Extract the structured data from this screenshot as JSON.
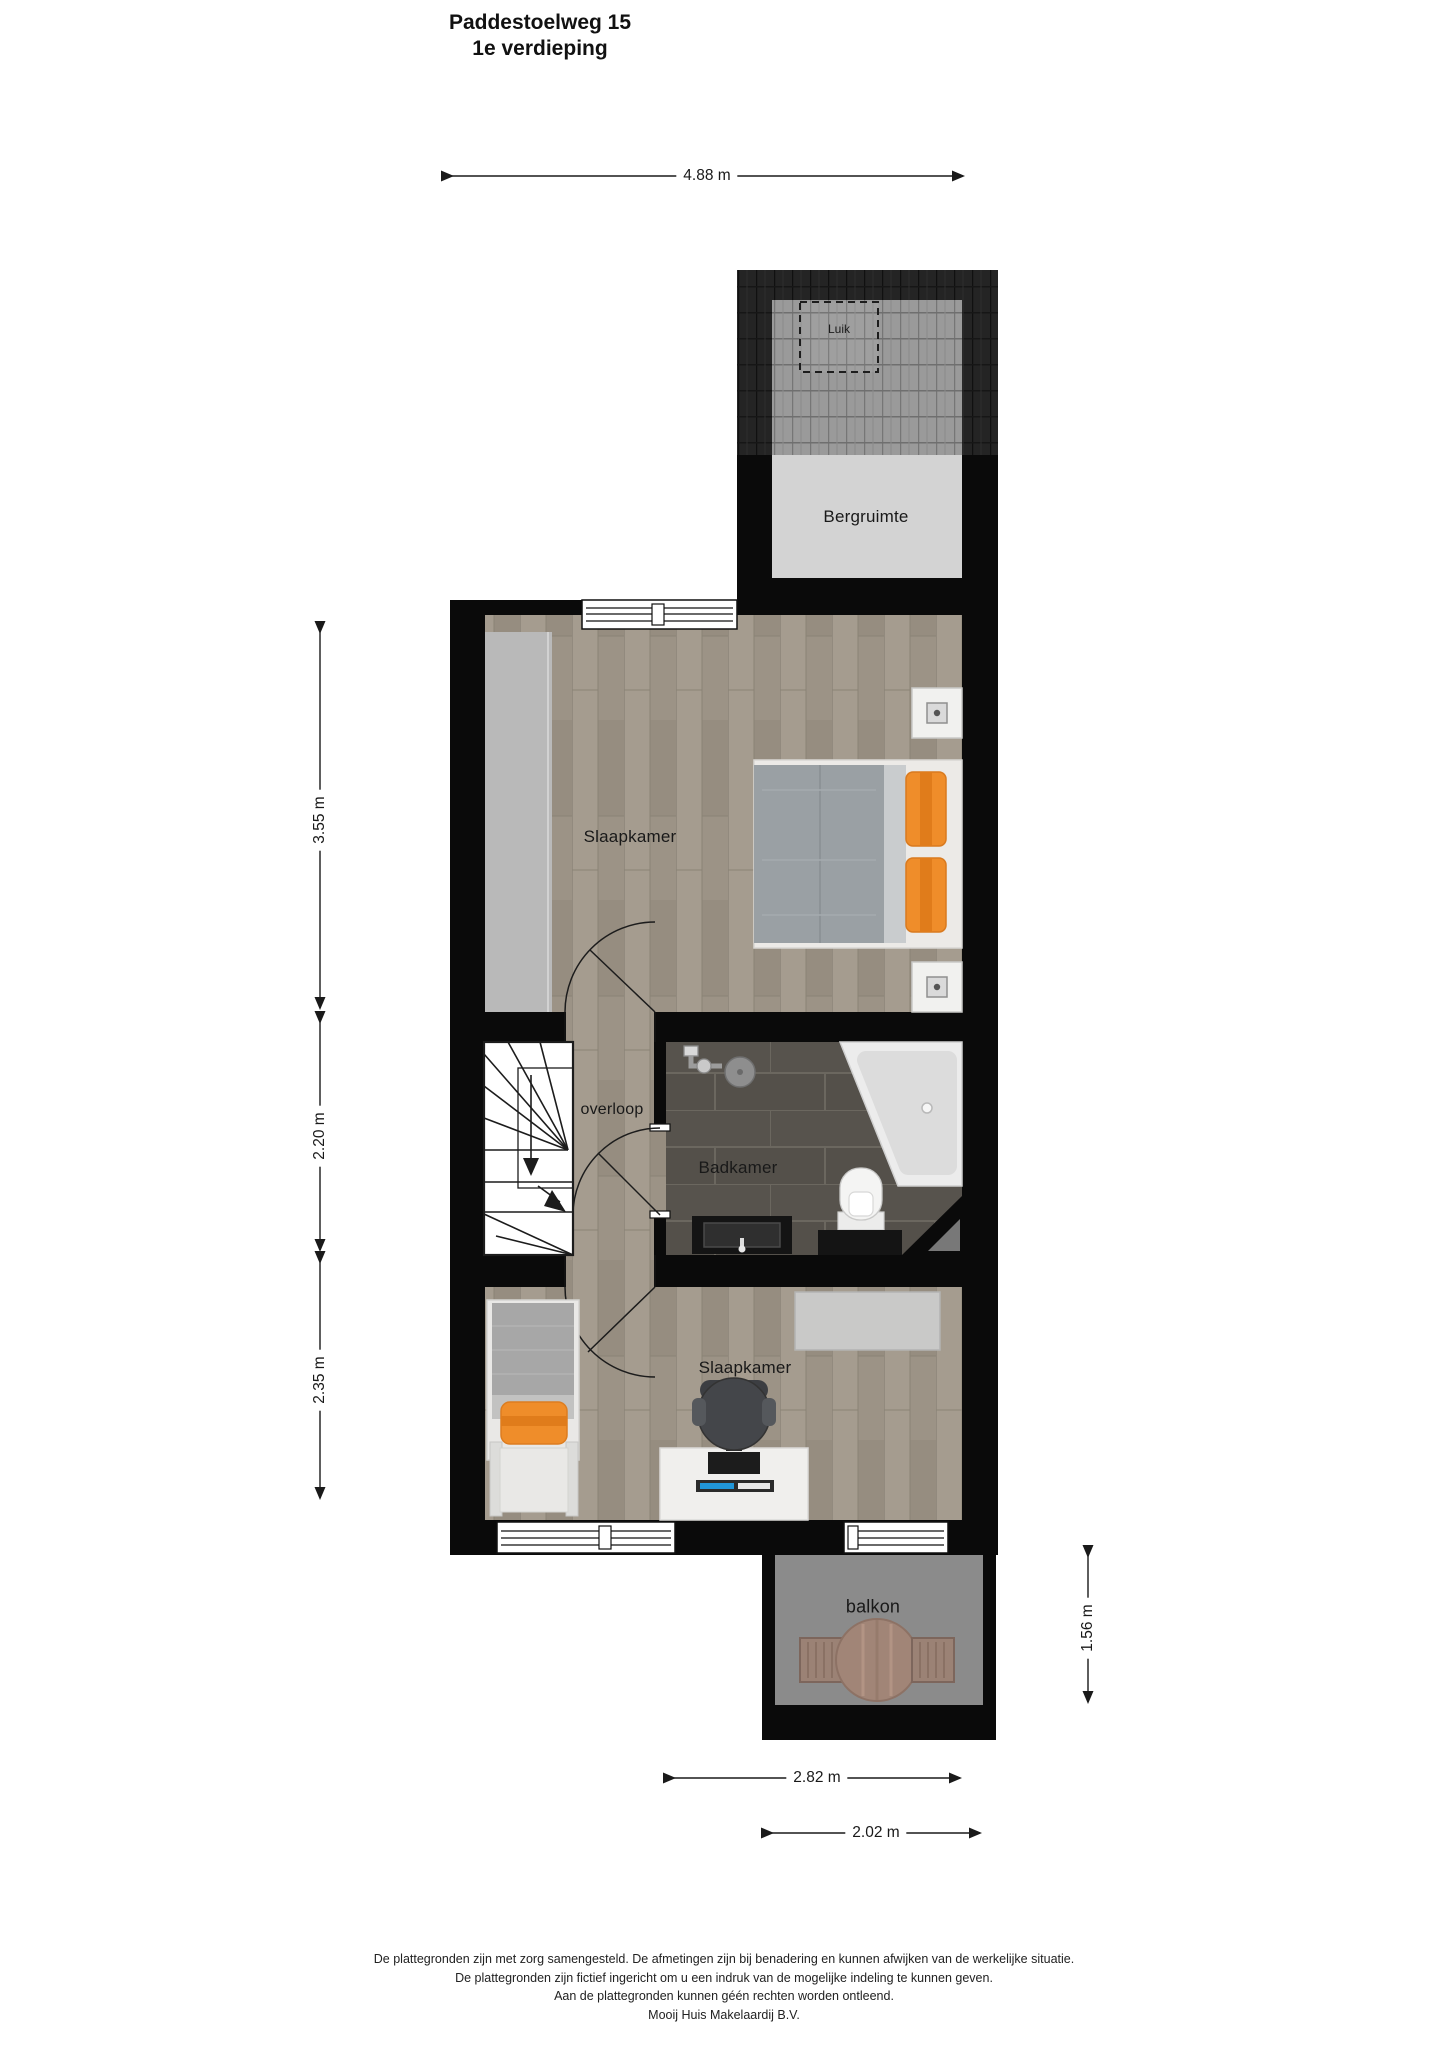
{
  "title": {
    "line1": "Paddestoelweg 15",
    "line2": "1e verdieping"
  },
  "rooms": {
    "bergruimte": "Bergruimte",
    "luik": "Luik",
    "slaapkamer1": "Slaapkamer",
    "overloop": "overloop",
    "badkamer": "Badkamer",
    "slaapkamer2": "Slaapkamer",
    "balkon": "balkon"
  },
  "dimensions": {
    "top_width": "4.88 m",
    "left_top": "3.55 m",
    "left_middle": "2.20 m",
    "left_bottom": "2.35 m",
    "right_balcony": "1.56 m",
    "bottom_outer": "2.82 m",
    "bottom_inner": "2.02 m"
  },
  "footer": {
    "line1": "De plattegronden zijn met zorg samengesteld. De afmetingen zijn bij benadering en kunnen afwijken van de werkelijke situatie.",
    "line2": "De plattegronden zijn fictief ingericht om u een indruk van de mogelijke indeling te kunnen geven.",
    "line3": "Aan de plattegronden kunnen géén rechten worden ontleend.",
    "line4": "Mooij Huis Makelaardij B.V."
  },
  "colors": {
    "wall": "#0a0a0a",
    "wood_floor": "#9d9487",
    "bathroom_tile": "#54504a",
    "storage_floor": "#d3d3d3",
    "balcony_floor": "#8b8b8b",
    "closet": "#b9b9b9",
    "accent_orange": "#ef8d2a",
    "stairs": "#ffffff"
  }
}
